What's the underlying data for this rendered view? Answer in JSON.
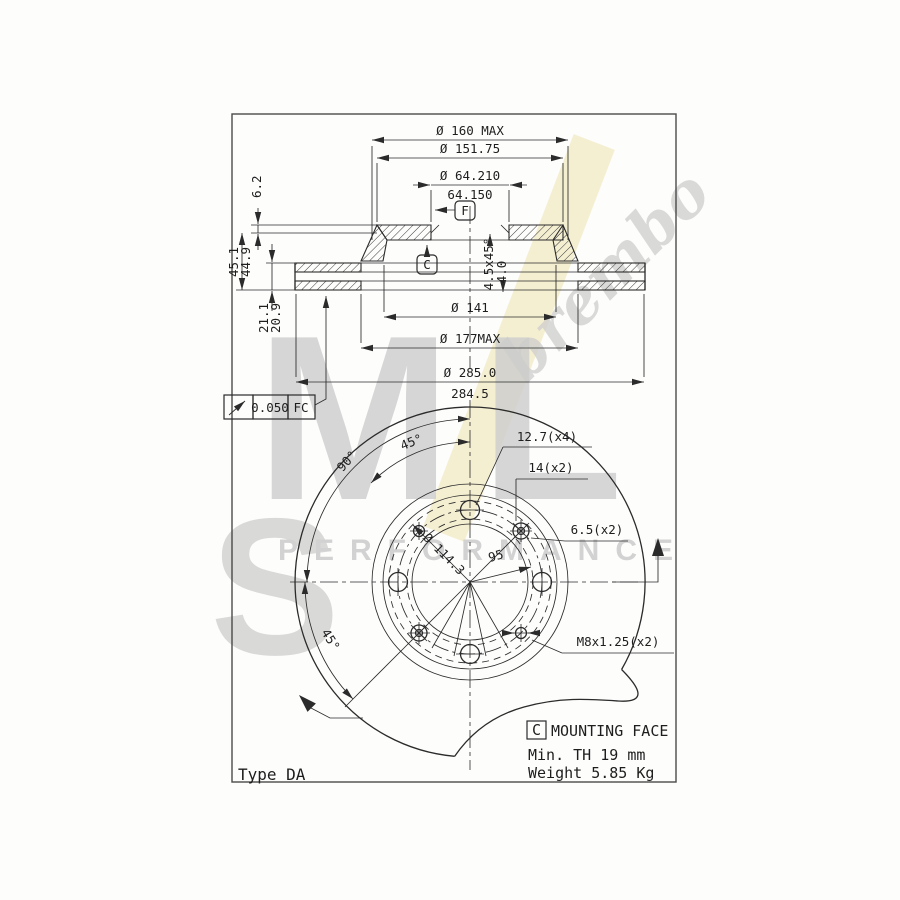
{
  "colors": {
    "line": "#2b2b2b",
    "watermark": "#cdcdcd",
    "stripe": "#f3ecca"
  },
  "watermark": {
    "big_letters": "ML",
    "script": "brembo",
    "tagline": "PERFORMANCE"
  },
  "drawing": {
    "type_label": "Type DA",
    "section": {
      "dim_160": "Ø 160 MAX",
      "dim_15175": "Ø 151.75",
      "dim_64_hi": "Ø 64.210",
      "dim_64_lo": "64.150",
      "datum_f": "F",
      "datum_c": "C",
      "dim_62": "6.2",
      "dim_451": "45.1",
      "dim_449": "44.9",
      "dim_211": "21.1",
      "dim_209": "20.9",
      "chamfer": "4.5x45°",
      "depth": "4.0",
      "dim_141": "Ø 141",
      "dim_177": "Ø 177MAX",
      "dim_285_hi": "Ø 285.0",
      "dim_285_lo": "284.5",
      "tol_value": "0.050",
      "tol_datum": "FC"
    },
    "plan": {
      "holes_127": "12.7(x4)",
      "holes_14": "14(x2)",
      "holes_65": "6.5(x2)",
      "thread": "M8x1.25(x2)",
      "bolt_circle": "Ø 114.3",
      "dim_95": "95",
      "angle_45_top": "45°",
      "angle_90": "90°",
      "angle_45_bottom": "45°"
    },
    "notes": {
      "datum_c": "C",
      "mounting_face": "MOUNTING FACE",
      "min_th": "Min. TH 19 mm",
      "weight": "Weight 5.85 Kg"
    }
  }
}
